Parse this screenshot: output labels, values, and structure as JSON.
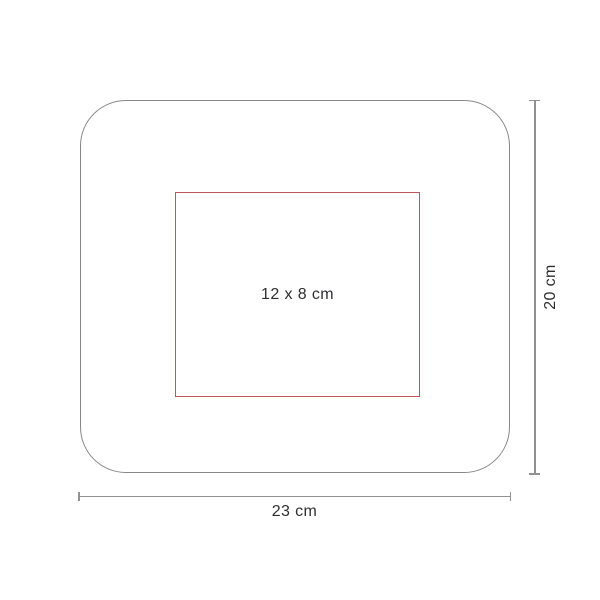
{
  "diagram": {
    "type": "product-print-area-dimension-drawing",
    "print_area_label": "12 x 8 cm",
    "width_dimension_label": "23 cm",
    "height_dimension_label": "20 cm",
    "colors": {
      "background": "#ffffff",
      "product_outline": "#85878a",
      "dimension_line": "#8f9193",
      "print_area_outline": "#bf555b",
      "label_text": "#2e2f31"
    }
  }
}
